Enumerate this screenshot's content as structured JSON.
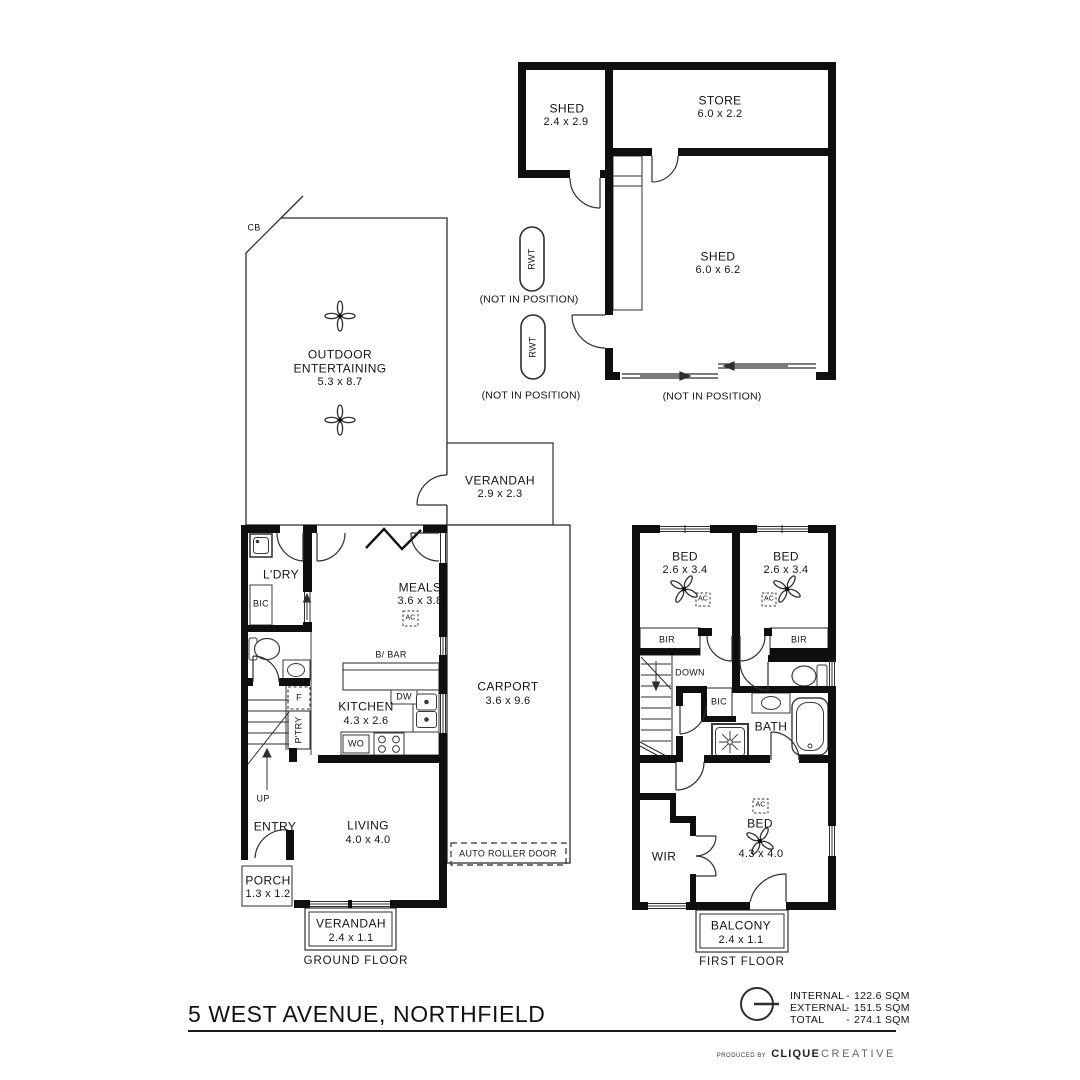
{
  "header": {
    "address": "5 WEST AVENUE, NORTHFIELD"
  },
  "floors": {
    "ground": "GROUND FLOOR",
    "first": "FIRST FLOOR"
  },
  "rooms": {
    "shed_small": {
      "name": "SHED",
      "dims": "2.4 x 2.9"
    },
    "store": {
      "name": "STORE",
      "dims": "6.0 x 2.2"
    },
    "shed_large": {
      "name": "SHED",
      "dims": "6.0 x 6.2"
    },
    "outdoor": {
      "line1": "OUTDOOR",
      "line2": "ENTERTAINING",
      "dims": "5.3 x 8.7"
    },
    "verandah_rear": {
      "name": "VERANDAH",
      "dims": "2.9 x 2.3"
    },
    "ldry": {
      "name": "L'DRY"
    },
    "meals": {
      "name": "MEALS",
      "dims": "3.6 x 3.8"
    },
    "kitchen": {
      "name": "KITCHEN",
      "dims": "4.3 x 2.6"
    },
    "living": {
      "name": "LIVING",
      "dims": "4.0 x 4.0"
    },
    "entry": {
      "name": "ENTRY"
    },
    "porch": {
      "name": "PORCH",
      "dims": "1.3 x 1.2"
    },
    "verandah_front": {
      "name": "VERANDAH",
      "dims": "2.4 x 1.1"
    },
    "carport": {
      "name": "CARPORT",
      "dims": "3.6 x 9.6"
    },
    "bed1": {
      "name": "BED",
      "dims": "2.6 x 3.4"
    },
    "bed2": {
      "name": "BED",
      "dims": "2.6 x 3.4"
    },
    "bed3": {
      "name": "BED",
      "dims": "4.3 x 4.0"
    },
    "bath": {
      "name": "BATH"
    },
    "wir": {
      "name": "WIR"
    },
    "balcony": {
      "name": "BALCONY",
      "dims": "2.4 x 1.1"
    }
  },
  "tags": {
    "bic": "BIC",
    "bir": "BIR",
    "ptry": "P'TRY",
    "fridge": "F",
    "dw": "DW",
    "wo": "WO",
    "bbar": "B/ BAR",
    "ac": "AC",
    "rwt": "RWT",
    "cb": "CB",
    "up": "UP",
    "down": "DOWN"
  },
  "notes": {
    "not_in_position": "(NOT IN POSITION)",
    "auto_roller_door": "AUTO ROLLER DOOR"
  },
  "summary": {
    "dash": "-",
    "rows": [
      {
        "label": "INTERNAL",
        "value": "122.6 SQM"
      },
      {
        "label": "EXTERNAL",
        "value": "151.5 SQM"
      },
      {
        "label": "TOTAL",
        "value": "274.1 SQM"
      }
    ]
  },
  "footer": {
    "produced_by": "PRODUCED BY",
    "brand_primary": "CLIQUE",
    "brand_secondary": "CREATIVE"
  },
  "colors": {
    "wall": "#0f0f0f",
    "line": "#2e2e2e",
    "text": "#141414"
  }
}
